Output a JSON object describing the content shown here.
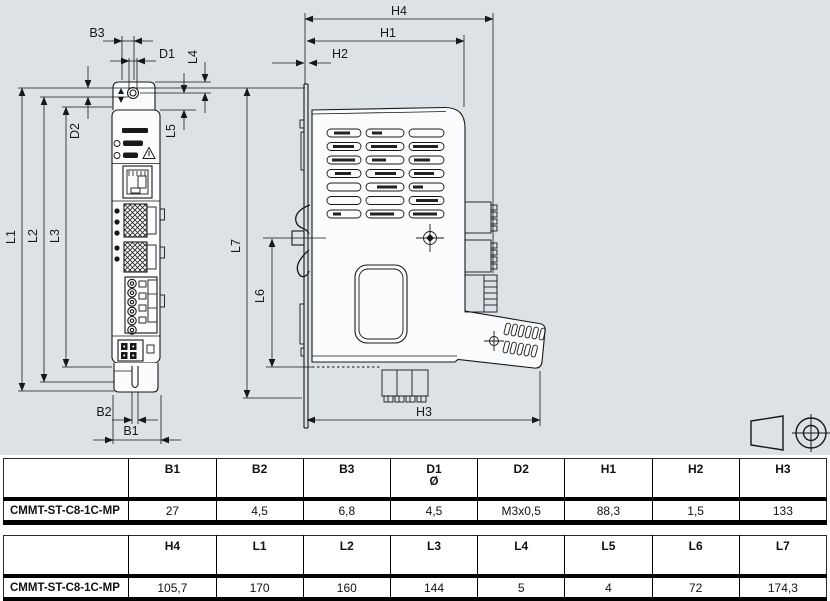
{
  "colors": {
    "drawing_bg": "#dde2e7",
    "line": "#16181a",
    "table_border": "#000000"
  },
  "drawing": {
    "dim_labels": {
      "b1": "B1",
      "b2": "B2",
      "b3": "B3",
      "d1": "D1",
      "d2": "D2",
      "h1": "H1",
      "h2": "H2",
      "h3": "H3",
      "h4": "H4",
      "l1": "L1",
      "l2": "L2",
      "l3": "L3",
      "l4": "L4",
      "l5": "L5",
      "l6": "L6",
      "l7": "L7"
    }
  },
  "tables": [
    {
      "row_label": "CMMT-ST-C8-1C-MP",
      "columns": [
        "B1",
        "B2",
        "B3",
        "D1",
        "D2",
        "H1",
        "H2",
        "H3"
      ],
      "sub_headers": [
        "",
        "",
        "",
        "Ø",
        "",
        "",
        "",
        ""
      ],
      "values": [
        "27",
        "4,5",
        "6,8",
        "4,5",
        "M3x0,5",
        "88,3",
        "1,5",
        "133"
      ]
    },
    {
      "row_label": "CMMT-ST-C8-1C-MP",
      "columns": [
        "H4",
        "L1",
        "L2",
        "L3",
        "L4",
        "L5",
        "L6",
        "L7"
      ],
      "sub_headers": [
        "",
        "",
        "",
        "",
        "",
        "",
        "",
        ""
      ],
      "values": [
        "105,7",
        "170",
        "160",
        "144",
        "5",
        "4",
        "72",
        "174,3"
      ]
    }
  ]
}
